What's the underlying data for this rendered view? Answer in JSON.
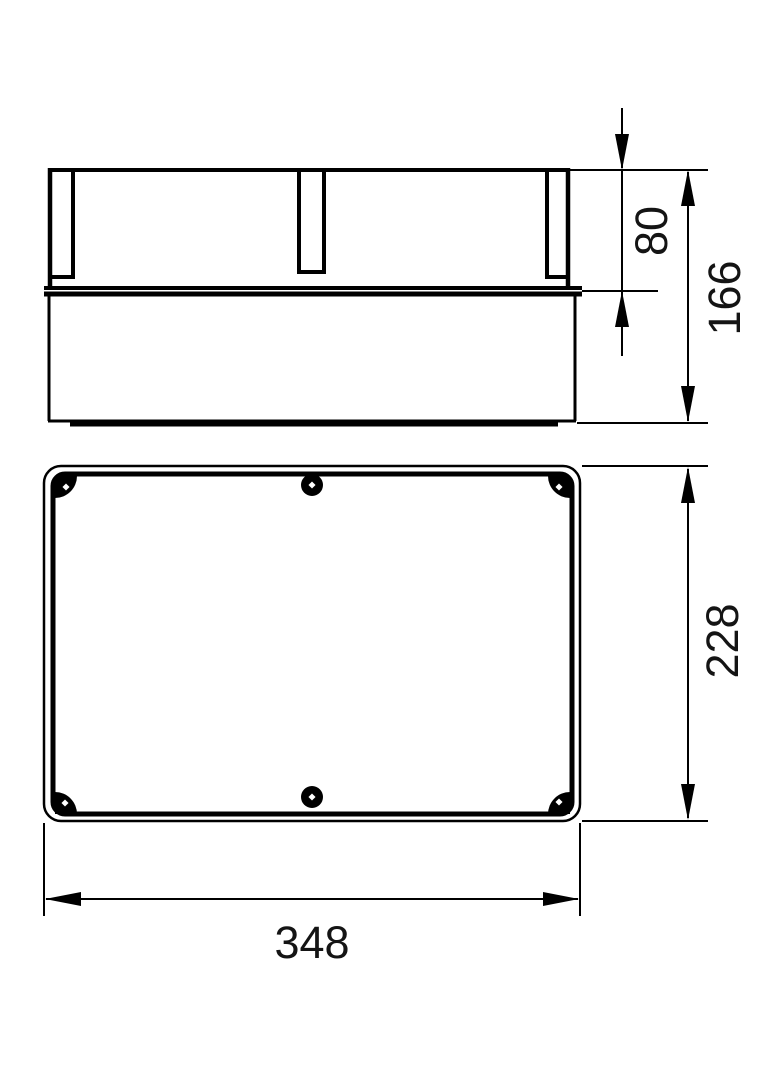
{
  "page": {
    "background": "#ffffff",
    "line_color": "#000000"
  },
  "dimensions": {
    "lid_height": "80",
    "total_height": "166",
    "plan_height": "228",
    "plan_width": "348"
  }
}
